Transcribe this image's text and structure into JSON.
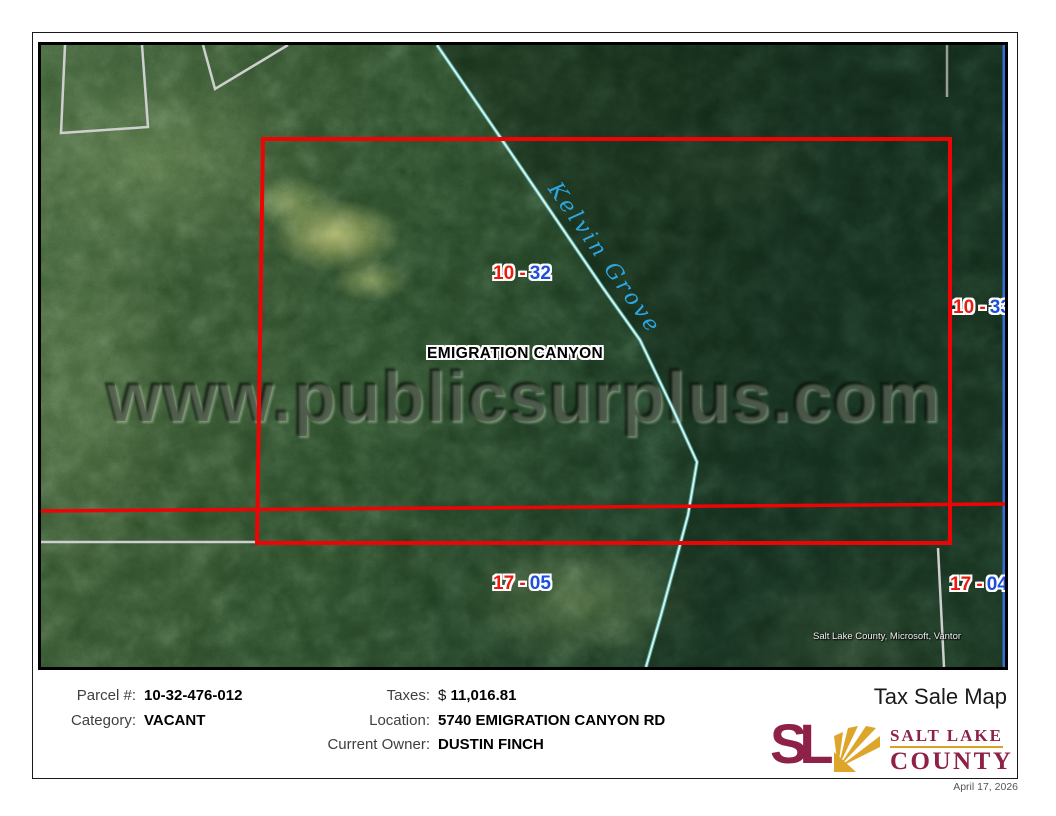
{
  "title": "Tax Sale Map",
  "date": "April 17, 2026",
  "info": {
    "left_rows": [
      {
        "label": "Parcel #:",
        "prefix": "",
        "value": "10-32-476-012"
      },
      {
        "label": "Category:",
        "prefix": "",
        "value": "VACANT"
      }
    ],
    "right_rows": [
      {
        "label": "Taxes:",
        "prefix": "$ ",
        "value": "11,016.81"
      },
      {
        "label": "Location:",
        "prefix": "",
        "value": "5740 EMIGRATION CANYON RD"
      },
      {
        "label": "Current Owner:",
        "prefix": "",
        "value": "DUSTIN FINCH"
      }
    ]
  },
  "logo": {
    "monogram": "SL",
    "name_line1": "SALT LAKE",
    "name_line2": "COUNTY"
  },
  "map": {
    "watermark": "www.publicsurplus.com",
    "attribution": "Salt Lake County, Microsoft, Vantor",
    "road_label": "Kelvin Grove",
    "area_label": "EMIGRATION CANYON",
    "parcel_labels": [
      {
        "red": "10 -",
        "blue": "32"
      },
      {
        "red": "10 -",
        "blue": "33"
      },
      {
        "red": "17 -",
        "blue": "05"
      },
      {
        "red": "17 -",
        "blue": "04"
      }
    ],
    "colors": {
      "parcel_boundary_red": "#ee0404",
      "label_red": "#ea1c12",
      "label_blue": "#1d4fdd",
      "road_line_cyan": "#c9f5f2",
      "road_text_cyan": "#2ea6e2",
      "neatline_blue": "#2e6ed6",
      "survey_line_gray": "#cfcfcf",
      "logo_maroon": "#8e2148",
      "logo_gold": "#dda62b"
    }
  }
}
